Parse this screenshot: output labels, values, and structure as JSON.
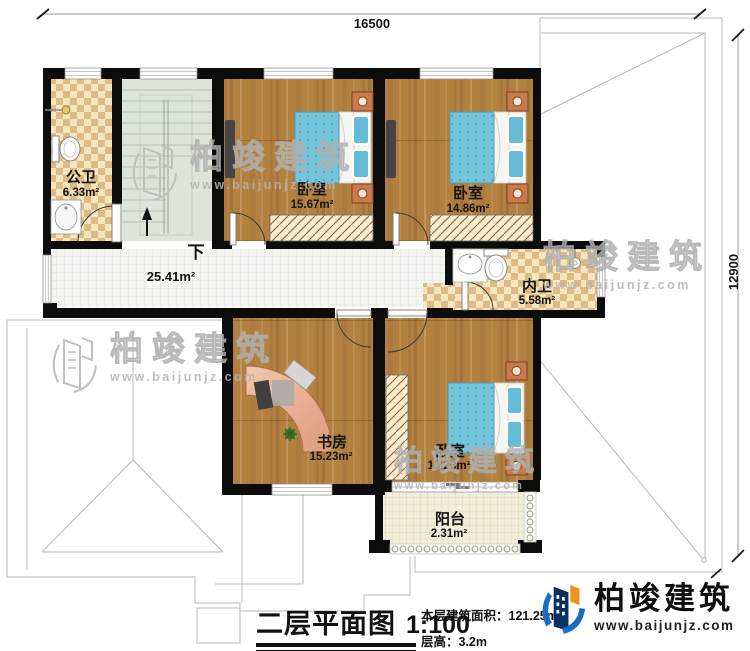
{
  "dims": {
    "width_mm": "16500",
    "height_mm": "12900"
  },
  "rooms": {
    "gongwei": {
      "name": "公卫",
      "area": "6.33m²"
    },
    "bedroom1": {
      "name": "卧室",
      "area": "15.67m²"
    },
    "bedroom2": {
      "name": "卧室",
      "area": "14.86m²"
    },
    "neiwei": {
      "name": "内卫",
      "area": "5.58m²"
    },
    "hall": {
      "area": "25.41m²",
      "down": "下"
    },
    "study": {
      "name": "书房",
      "area": "15.23m²"
    },
    "bedroom3": {
      "name": "卧室",
      "area": "15.23m²"
    },
    "balcony": {
      "name": "阳台",
      "area": "2.31m²"
    }
  },
  "title_block": {
    "title": "二层平面图",
    "scale": "1:100",
    "area_text": "本层建筑面积：121.25m²",
    "floor_height_text": "层高：3.2m"
  },
  "brand": {
    "name": "柏竣建筑",
    "website": "www.baijunjz.com"
  },
  "watermark": {
    "name": "柏竣建筑",
    "website": "www.baijunjz.com"
  },
  "colors": {
    "wall": "#0c0c0c",
    "wood_floor": "#b2813f",
    "bath_tile_light": "#f6e6bd",
    "bath_tile_dark": "#debb85",
    "stairs": "#dee4da",
    "mattress": "#74c4dc",
    "brand_blue": "#1a6cc0",
    "brand_navy": "#0b2e63",
    "brand_orange": "#f0941d"
  }
}
